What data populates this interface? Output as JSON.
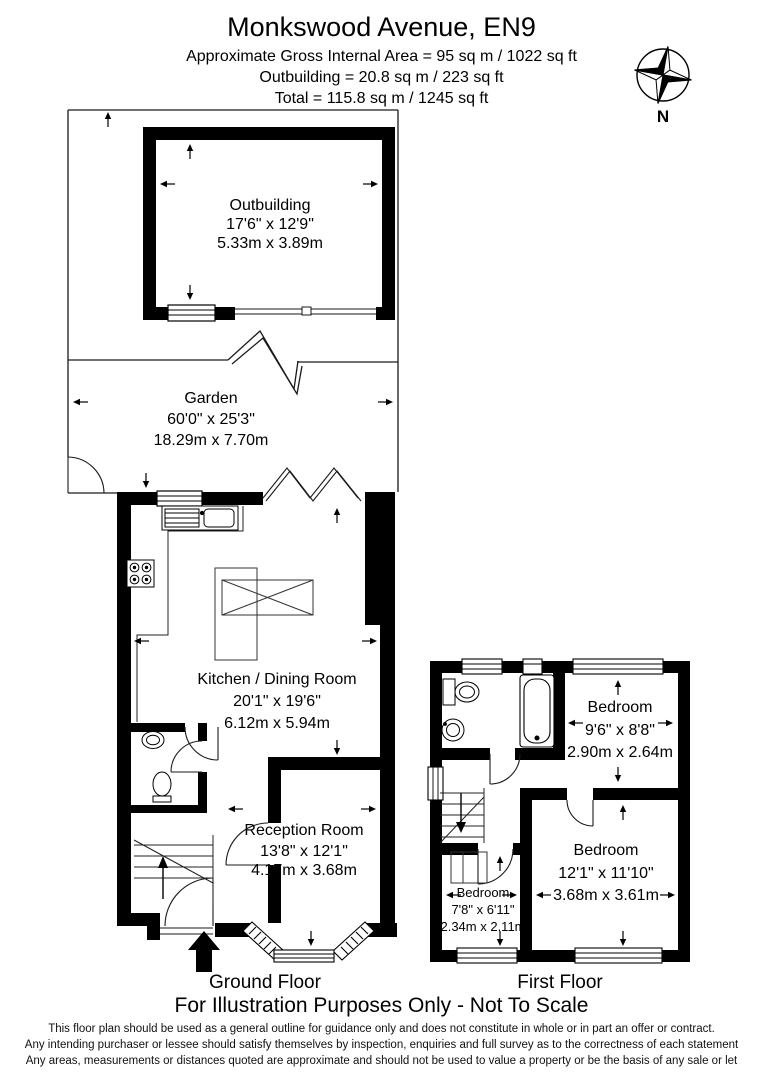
{
  "header": {
    "title": "Monkswood Avenue, EN9",
    "area_line": "Approximate Gross Internal Area = 95 sq m / 1022 sq ft",
    "outbuilding_line": "Outbuilding = 20.8 sq m / 223 sq ft",
    "total_line": "Total = 115.8 sq m / 1245 sq ft"
  },
  "compass": {
    "north_label": "N"
  },
  "ground_floor": {
    "label": "Ground Floor",
    "rooms": {
      "outbuilding": {
        "name": "Outbuilding",
        "imperial": "17'6\" x 12'9\"",
        "metric": "5.33m x 3.89m"
      },
      "garden": {
        "name": "Garden",
        "imperial": "60'0\" x 25'3\"",
        "metric": "18.29m x 7.70m"
      },
      "kitchen": {
        "name": "Kitchen / Dining Room",
        "imperial": "20'1\" x 19'6\"",
        "metric": "6.12m x 5.94m"
      },
      "reception": {
        "name": "Reception Room",
        "imperial": "13'8\" x 12'1\"",
        "metric": "4.17m x 3.68m"
      }
    }
  },
  "first_floor": {
    "label": "First Floor",
    "rooms": {
      "bedroom_top": {
        "name": "Bedroom",
        "imperial": "9'6\" x 8'8\"",
        "metric": "2.90m x 2.64m"
      },
      "bedroom_large": {
        "name": "Bedroom",
        "imperial": "12'1\" x 11'10\"",
        "metric": "3.68m x 3.61m"
      },
      "bedroom_small": {
        "name": "Bedroom",
        "imperial": "7'8\" x 6'11\"",
        "metric": "2.34m x 2.11m"
      }
    }
  },
  "footer": {
    "illustration_note": "For Illustration Purposes Only - Not To Scale",
    "disclaimer": [
      "This floor plan should be used as a general outline for guidance only and does not constitute in whole or in part an offer or contract.",
      "Any intending purchaser or lessee should satisfy themselves by inspection, enquiries and full survey as to the correctness of each statement",
      "Any areas, measurements or distances quoted are approximate and should not be used to value a property or be the basis of any sale or let"
    ]
  },
  "colors": {
    "wall": "#000000",
    "line": "#1a1a1a",
    "background": "#ffffff"
  }
}
